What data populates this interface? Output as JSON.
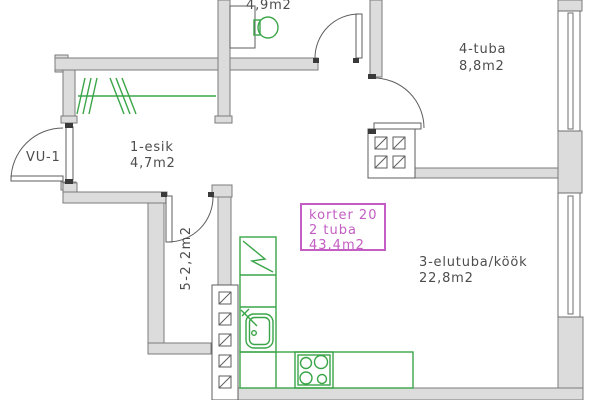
{
  "plan": {
    "apartment_tag": {
      "line1": "korter  20",
      "line2": "2  tuba",
      "line3": "43,4m2"
    },
    "entrance": {
      "label": "VU-1"
    },
    "rooms": {
      "wc": {
        "area": "4,9m2"
      },
      "tuba4": {
        "name": "4-tuba",
        "area": "8,8m2"
      },
      "esik": {
        "name": "1-esik",
        "area": "4,7m2"
      },
      "elutuba": {
        "name": "3-elutuba/köök",
        "area": "22,8m2"
      },
      "closet": {
        "label": "5-2,2m2"
      }
    },
    "colors": {
      "wall_fill": "#dcdcdc",
      "wall_outline": "#7b7b7b",
      "fixture_green": "#3aa548",
      "tag_magenta": "#c45ec4",
      "label_text": "#4d4d4d"
    }
  }
}
